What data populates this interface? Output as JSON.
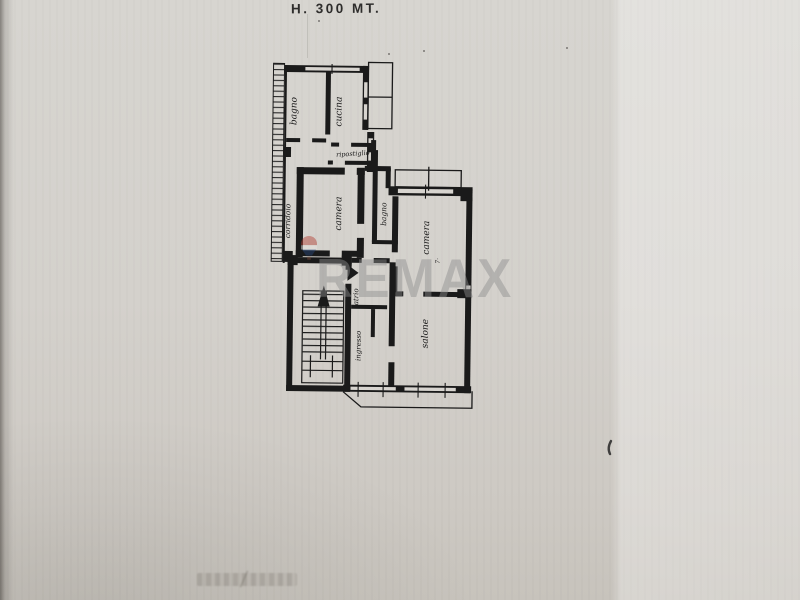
{
  "header": {
    "height_note": "H. 300 MT."
  },
  "floor_plan": {
    "rooms": [
      {
        "name": "bagno-top",
        "label": "bagno"
      },
      {
        "name": "cucina",
        "label": "cucina"
      },
      {
        "name": "ripostiglio",
        "label": "ripostiglio"
      },
      {
        "name": "corridoio",
        "label": "corridoio"
      },
      {
        "name": "camera-middle",
        "label": "camera"
      },
      {
        "name": "bagno-right",
        "label": "bagno"
      },
      {
        "name": "camera-right",
        "label": "camera"
      },
      {
        "name": "camera-right-note",
        "label": "7·"
      },
      {
        "name": "atrio",
        "label": "atrio"
      },
      {
        "name": "ingresso",
        "label": "ingresso"
      },
      {
        "name": "salone",
        "label": "salone"
      }
    ]
  },
  "watermark": {
    "text": "REMAX"
  },
  "colors": {
    "paper": "#d4d1cc",
    "paper_light": "#dcdad6",
    "ink": "#1a1a1a",
    "watermark_gray": "#8d8d8d",
    "balloon_red": "#b23a30",
    "balloon_blue": "#28477d"
  }
}
